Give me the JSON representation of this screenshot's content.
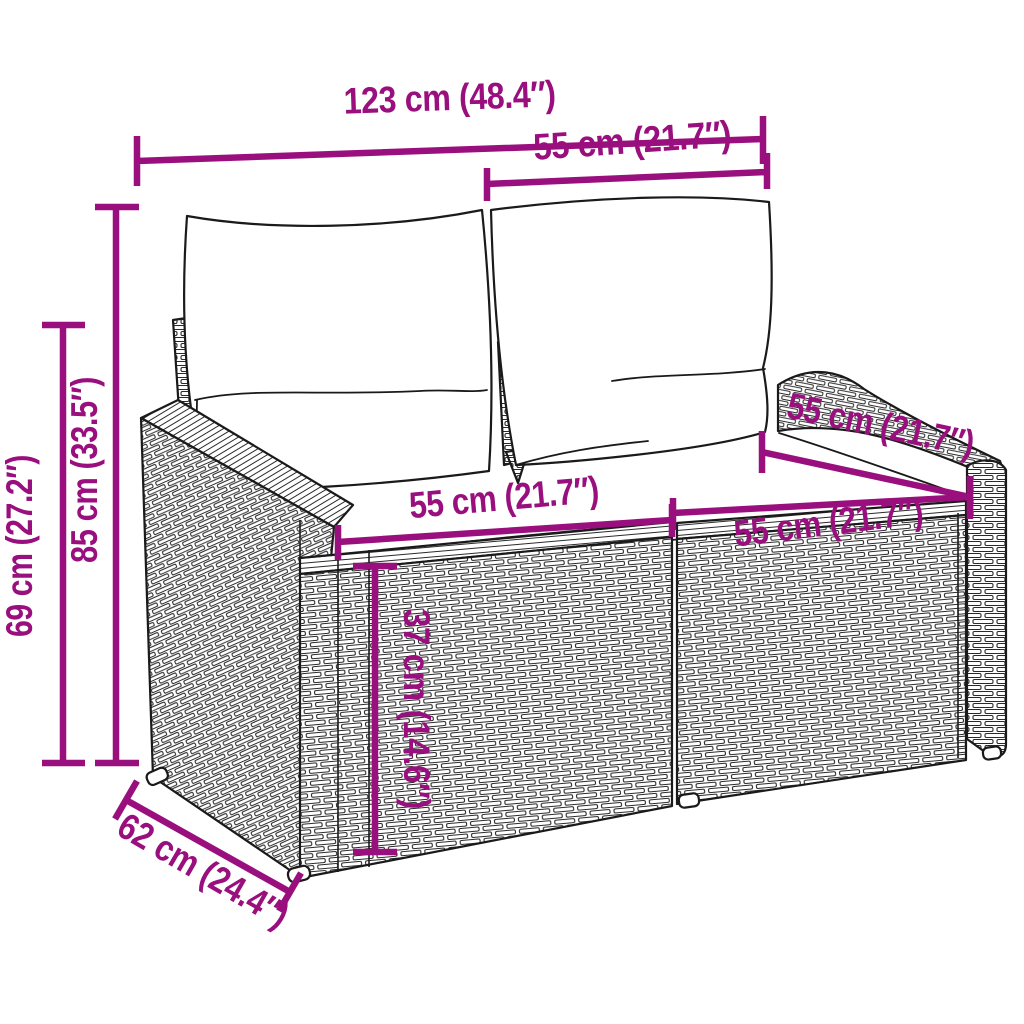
{
  "colors": {
    "dimension_magenta": "#9a0f7e",
    "line_black": "#1a1a1a",
    "background": "#ffffff"
  },
  "figure": {
    "subject": "Poly rattan 2-seater garden sofa with back and seat cushions, dimension drawing"
  },
  "dimensions": {
    "total_width": {
      "label": "123 cm (48.4″)"
    },
    "backrest_width": {
      "label": "55 cm (21.7″)"
    },
    "total_height": {
      "label": "85 cm (33.5″)"
    },
    "armrest_height": {
      "label": "69 cm (27.2″)"
    },
    "seat_depth": {
      "label": "55 cm (21.7″)"
    },
    "seat_width_left": {
      "label": "55 cm (21.7″)"
    },
    "seat_width_right": {
      "label": "55 cm (21.7″)"
    },
    "seat_height": {
      "label": "37 cm (14.6″)"
    },
    "total_depth": {
      "label": "62 cm (24.4″)"
    }
  }
}
